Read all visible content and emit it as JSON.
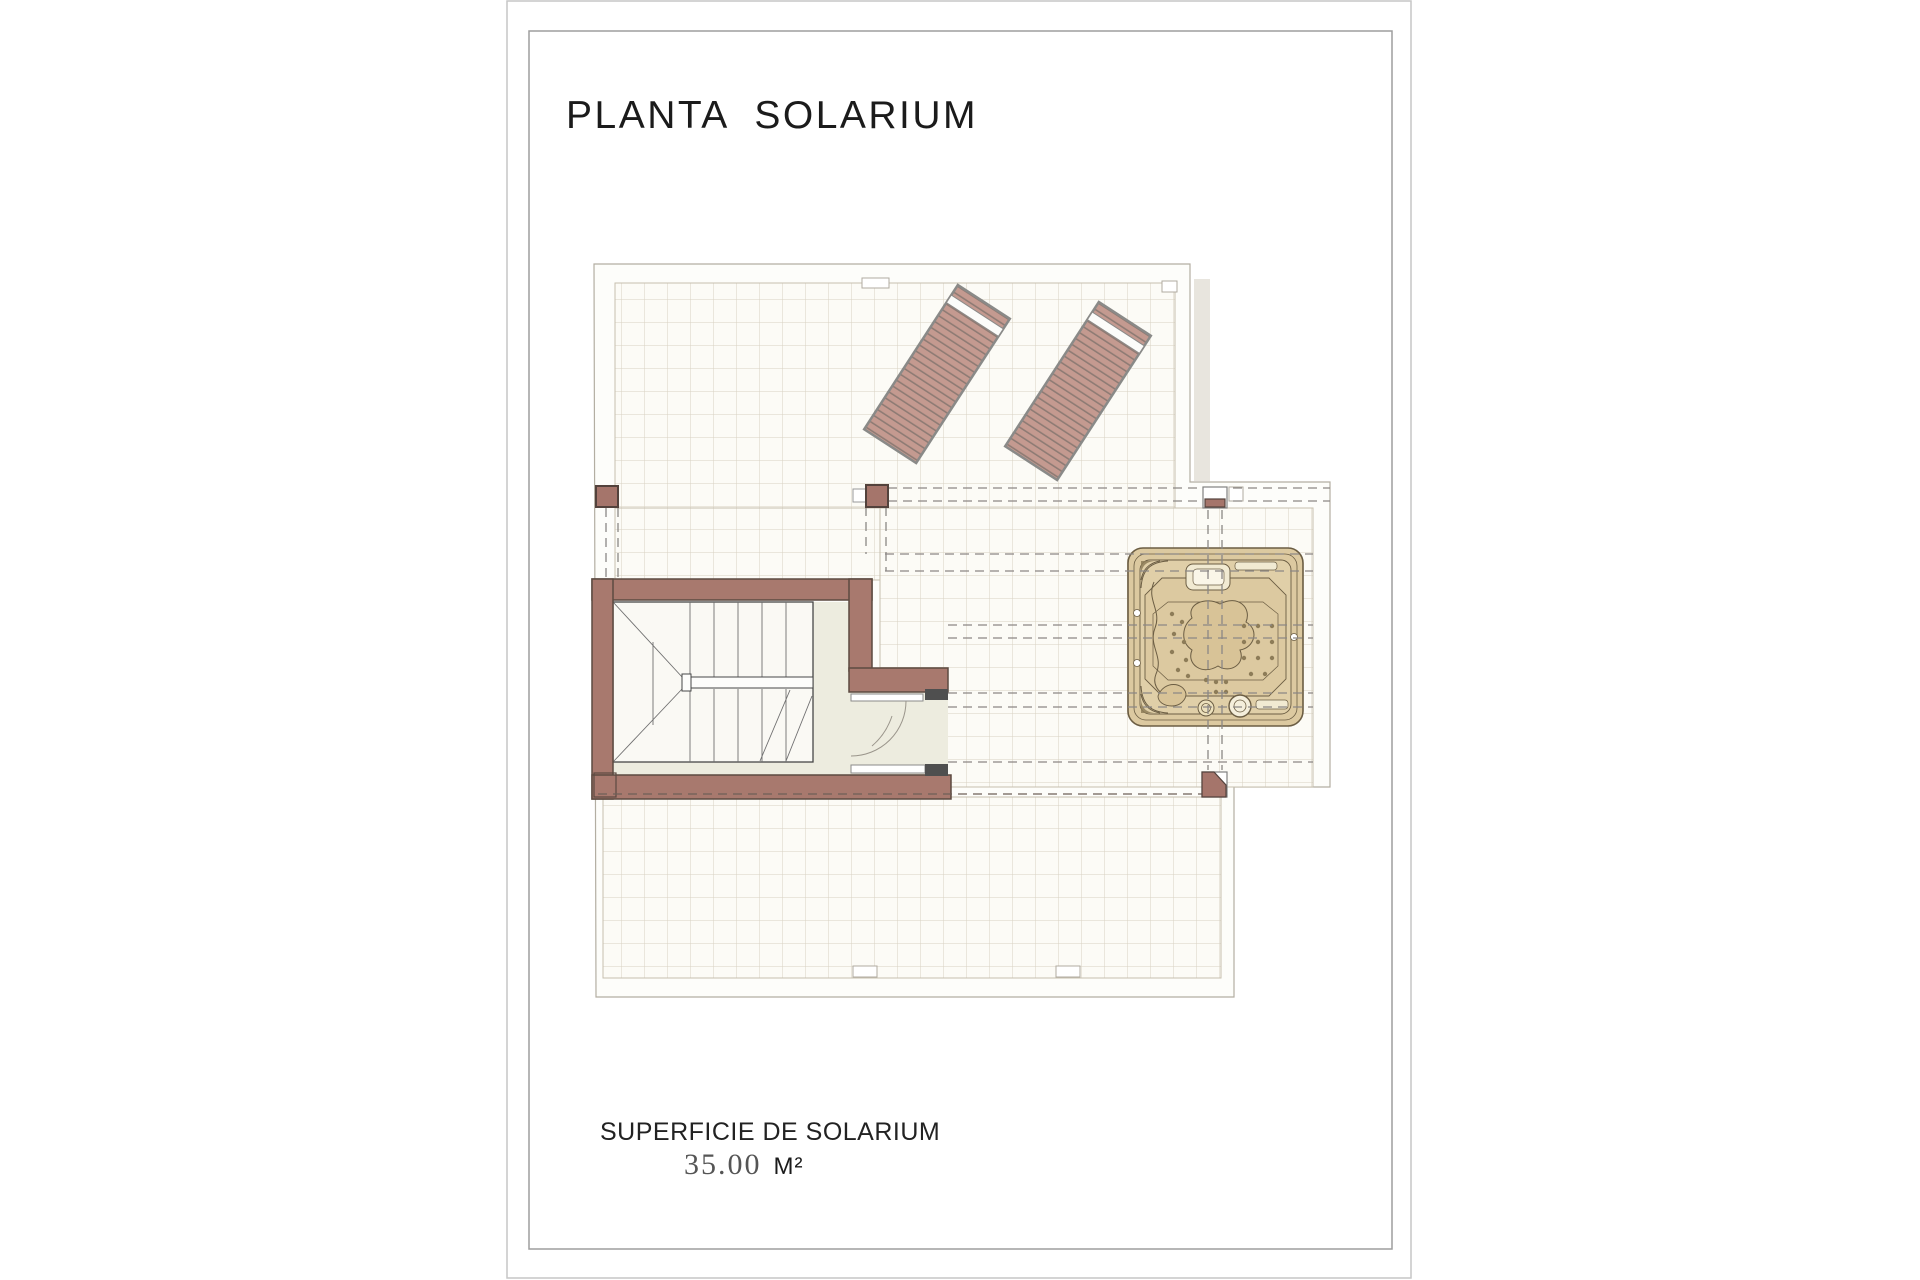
{
  "sheet": {
    "title": "PLANTA  SOLARIUM"
  },
  "footer": {
    "surface_label": "SUPERFICIE DE SOLARIUM",
    "surface_value": "35.00",
    "surface_unit": "M²"
  },
  "plan": {
    "features": {
      "upper_terrace": "tiled solarium terrace",
      "sun_loungers": 2,
      "staircase": "stairwell with winder stairs and handrail",
      "corridor": "stair landing with two doors",
      "jacuzzi": "square hot tub with seats and jets",
      "lower_terrace": "tiled solarium terrace",
      "pergola_posts": 4
    },
    "palette": {
      "wall_fill": "#a8796e",
      "wall_outline": "#5c4a41",
      "post_fill": "#a5756b",
      "lounger_slat": "#c49a90",
      "lounger_slat_line": "#8e7b74",
      "lounger_frame": "#8a8a88",
      "jacuzzi_body": "#dcc9a0",
      "jacuzzi_outline": "#6b5d43",
      "jet_dot": "#8d7c58",
      "grid_line": "#d8d1c2",
      "grid_border": "#c6bfae",
      "boundary_line": "#b3aea2",
      "dashed_line": "#8b8785",
      "corridor_floor": "#edecdf",
      "door_header": "#4f4f4f",
      "page_border": "#c6c6c6",
      "frame_border": "#9e9e9e",
      "title_color": "#1b1b1b",
      "value_color": "#555555"
    }
  }
}
